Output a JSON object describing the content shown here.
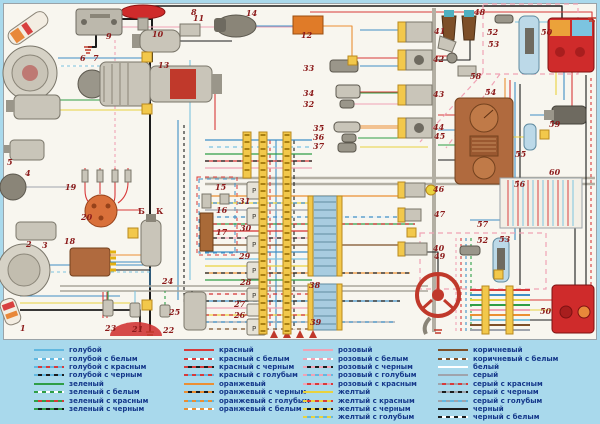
{
  "page": {
    "background": "#a9d9ec",
    "panel_background": "#f8f6ef"
  },
  "palette": {
    "голубой": "#62b8e0",
    "зеленый": "#2f9e46",
    "красный": "#d83a3a",
    "оранжевый": "#eb8f33",
    "розовый": "#f0a3b5",
    "желтый": "#e9d23f",
    "коричневый": "#7d4f28",
    "белый": "#ffffff",
    "серый": "#9fa4ac",
    "черный": "#1c1c1c",
    "number_label_color": "#8b1a1a",
    "legend_text_color": "#15388a"
  },
  "diagram": {
    "number_labels": [
      {
        "n": "1",
        "x": 20,
        "y": 331
      },
      {
        "n": "2",
        "x": 26,
        "y": 247
      },
      {
        "n": "3",
        "x": 42,
        "y": 248
      },
      {
        "n": "4",
        "x": 25,
        "y": 176
      },
      {
        "n": "5",
        "x": 7,
        "y": 165
      },
      {
        "n": "6",
        "x": 80,
        "y": 61
      },
      {
        "n": "7",
        "x": 93,
        "y": 61
      },
      {
        "n": "8",
        "x": 191,
        "y": 15
      },
      {
        "n": "9",
        "x": 106,
        "y": 39
      },
      {
        "n": "10",
        "x": 152,
        "y": 37
      },
      {
        "n": "11",
        "x": 193,
        "y": 21
      },
      {
        "n": "12",
        "x": 301,
        "y": 38
      },
      {
        "n": "13",
        "x": 158,
        "y": 68
      },
      {
        "n": "14",
        "x": 246,
        "y": 16
      },
      {
        "n": "15",
        "x": 215,
        "y": 190
      },
      {
        "n": "16",
        "x": 216,
        "y": 213
      },
      {
        "n": "17",
        "x": 216,
        "y": 235
      },
      {
        "n": "18",
        "x": 64,
        "y": 244
      },
      {
        "n": "19",
        "x": 65,
        "y": 190
      },
      {
        "n": "20",
        "x": 81,
        "y": 220
      },
      {
        "n": "21",
        "x": 132,
        "y": 332
      },
      {
        "n": "22",
        "x": 163,
        "y": 333
      },
      {
        "n": "23",
        "x": 105,
        "y": 331
      },
      {
        "n": "24",
        "x": 162,
        "y": 284
      },
      {
        "n": "25",
        "x": 169,
        "y": 315
      },
      {
        "n": "26",
        "x": 234,
        "y": 318
      },
      {
        "n": "27",
        "x": 234,
        "y": 307
      },
      {
        "n": "28",
        "x": 240,
        "y": 285
      },
      {
        "n": "29",
        "x": 239,
        "y": 259
      },
      {
        "n": "30",
        "x": 240,
        "y": 231
      },
      {
        "n": "31",
        "x": 239,
        "y": 204
      },
      {
        "n": "32",
        "x": 303,
        "y": 107
      },
      {
        "n": "33",
        "x": 303,
        "y": 71
      },
      {
        "n": "34",
        "x": 303,
        "y": 96
      },
      {
        "n": "35",
        "x": 313,
        "y": 131
      },
      {
        "n": "36",
        "x": 313,
        "y": 140
      },
      {
        "n": "37",
        "x": 313,
        "y": 149
      },
      {
        "n": "38",
        "x": 309,
        "y": 288
      },
      {
        "n": "39",
        "x": 310,
        "y": 325
      },
      {
        "n": "40",
        "x": 433,
        "y": 251
      },
      {
        "n": "41",
        "x": 434,
        "y": 34
      },
      {
        "n": "42",
        "x": 433,
        "y": 62
      },
      {
        "n": "43",
        "x": 433,
        "y": 97
      },
      {
        "n": "44",
        "x": 433,
        "y": 130
      },
      {
        "n": "45",
        "x": 434,
        "y": 139
      },
      {
        "n": "46",
        "x": 433,
        "y": 192
      },
      {
        "n": "47",
        "x": 434,
        "y": 217
      },
      {
        "n": "48",
        "x": 474,
        "y": 15
      },
      {
        "n": "49",
        "x": 434,
        "y": 259
      },
      {
        "n": "50",
        "x": 541,
        "y": 35
      },
      {
        "n": "50",
        "x": 540,
        "y": 314
      },
      {
        "n": "52",
        "x": 487,
        "y": 35
      },
      {
        "n": "53",
        "x": 488,
        "y": 47
      },
      {
        "n": "52",
        "x": 477,
        "y": 243
      },
      {
        "n": "53",
        "x": 499,
        "y": 242
      },
      {
        "n": "54",
        "x": 485,
        "y": 95
      },
      {
        "n": "55",
        "x": 515,
        "y": 157
      },
      {
        "n": "56",
        "x": 514,
        "y": 187
      },
      {
        "n": "57",
        "x": 477,
        "y": 227
      },
      {
        "n": "58",
        "x": 470,
        "y": 79
      },
      {
        "n": "59",
        "x": 549,
        "y": 127
      },
      {
        "n": "60",
        "x": 549,
        "y": 175
      }
    ],
    "letter_labels": [
      {
        "t": "Б",
        "x": 138,
        "y": 214
      },
      {
        "t": "К",
        "x": 156,
        "y": 214
      }
    ]
  },
  "legend": {
    "columns": [
      {
        "entries": [
          {
            "label": "голубой",
            "base": "#62b8e0",
            "dash": null
          },
          {
            "label": "голубой с белым",
            "base": "#62b8e0",
            "dash": "#ffffff"
          },
          {
            "label": "голубой с красным",
            "base": "#62b8e0",
            "dash": "#d83a3a"
          },
          {
            "label": "голубой с черным",
            "base": "#62b8e0",
            "dash": "#1c1c1c"
          },
          {
            "label": "зеленый",
            "base": "#2f9e46",
            "dash": null
          },
          {
            "label": "зеленый с белым",
            "base": "#2f9e46",
            "dash": "#ffffff"
          },
          {
            "label": "зеленый с красным",
            "base": "#2f9e46",
            "dash": "#d83a3a"
          },
          {
            "label": "зеленый с черным",
            "base": "#2f9e46",
            "dash": "#1c1c1c"
          }
        ]
      },
      {
        "entries": [
          {
            "label": "красный",
            "base": "#d83a3a",
            "dash": null
          },
          {
            "label": "красный с белым",
            "base": "#d83a3a",
            "dash": "#ffffff"
          },
          {
            "label": "красный с черным",
            "base": "#d83a3a",
            "dash": "#1c1c1c"
          },
          {
            "label": "красный с голубым",
            "base": "#d83a3a",
            "dash": "#62b8e0"
          },
          {
            "label": "оранжевый",
            "base": "#eb8f33",
            "dash": null
          },
          {
            "label": "оранжевый с черным",
            "base": "#eb8f33",
            "dash": "#1c1c1c"
          },
          {
            "label": "оранжевый с голубым",
            "base": "#eb8f33",
            "dash": "#62b8e0"
          },
          {
            "label": "оранжевый с белым",
            "base": "#eb8f33",
            "dash": "#ffffff"
          }
        ]
      },
      {
        "entries": [
          {
            "label": "розовый",
            "base": "#f0a3b5",
            "dash": null
          },
          {
            "label": "розовый с белым",
            "base": "#f0a3b5",
            "dash": "#ffffff"
          },
          {
            "label": "розовый с черным",
            "base": "#f0a3b5",
            "dash": "#1c1c1c"
          },
          {
            "label": "розовый с голубым",
            "base": "#f0a3b5",
            "dash": "#62b8e0"
          },
          {
            "label": "розовый с красным",
            "base": "#f0a3b5",
            "dash": "#d83a3a"
          },
          {
            "label": "желтый",
            "base": "#e9d23f",
            "dash": null
          },
          {
            "label": "желтый с красным",
            "base": "#e9d23f",
            "dash": "#d83a3a"
          },
          {
            "label": "желтый с черным",
            "base": "#e9d23f",
            "dash": "#1c1c1c"
          },
          {
            "label": "желтый с голубым",
            "base": "#e9d23f",
            "dash": "#62b8e0"
          }
        ]
      },
      {
        "entries": [
          {
            "label": "коричневый",
            "base": "#7d4f28",
            "dash": null
          },
          {
            "label": "коричневый с белым",
            "base": "#7d4f28",
            "dash": "#ffffff"
          },
          {
            "label": "белый",
            "base": "#ffffff",
            "dash": null
          },
          {
            "label": "серый",
            "base": "#9fa4ac",
            "dash": null
          },
          {
            "label": "серый с красным",
            "base": "#9fa4ac",
            "dash": "#d83a3a"
          },
          {
            "label": "серый с черным",
            "base": "#9fa4ac",
            "dash": "#1c1c1c"
          },
          {
            "label": "серый с голубым",
            "base": "#9fa4ac",
            "dash": "#62b8e0"
          },
          {
            "label": "черный",
            "base": "#1c1c1c",
            "dash": null
          },
          {
            "label": "черный с белым",
            "base": "#1c1c1c",
            "dash": "#ffffff"
          }
        ]
      }
    ]
  }
}
